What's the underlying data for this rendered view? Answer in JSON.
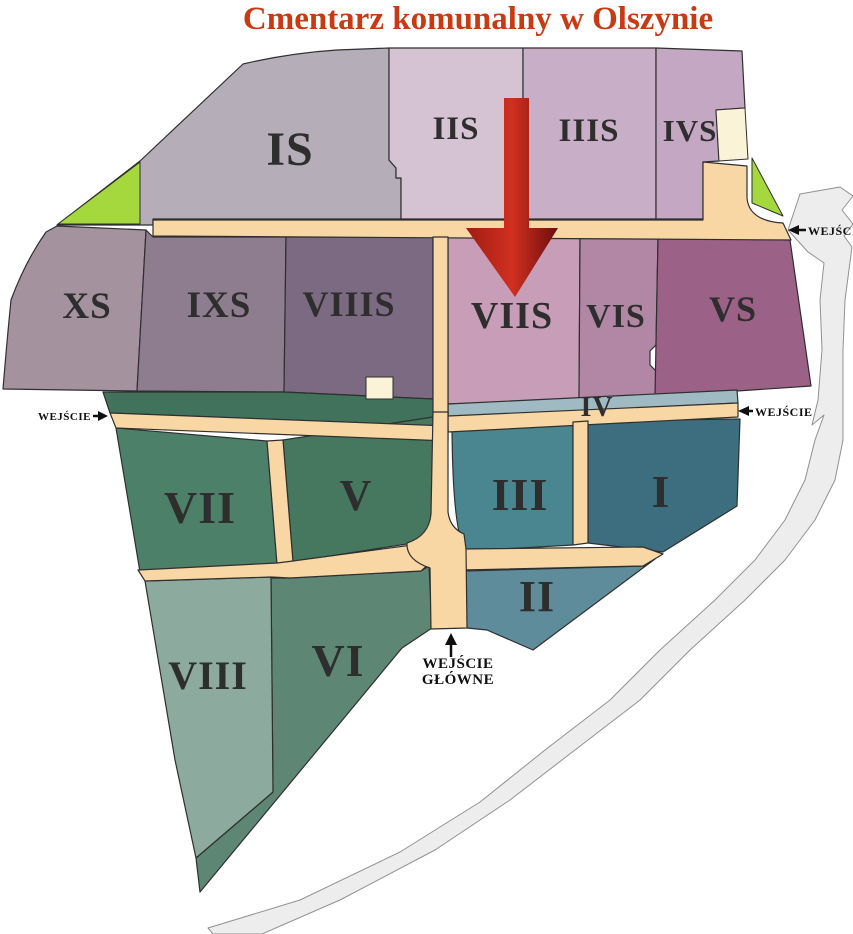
{
  "title": {
    "text": "Cmentarz komunalny w Olszynie",
    "color": "#c93a12"
  },
  "map": {
    "sections": [
      {
        "id": "IS",
        "label": "IS",
        "color": "#b5adb7"
      },
      {
        "id": "IIS",
        "label": "IIS",
        "color": "#d5c3d3"
      },
      {
        "id": "IIIS",
        "label": "IIIS",
        "color": "#c9aec7"
      },
      {
        "id": "IVS",
        "label": "IVS",
        "color": "#c4a7c2"
      },
      {
        "id": "XS",
        "label": "XS",
        "color": "#a5929f"
      },
      {
        "id": "IXS",
        "label": "IXS",
        "color": "#8e7d8e"
      },
      {
        "id": "VIIIS",
        "label": "VIIIS",
        "color": "#7b6a81"
      },
      {
        "id": "VIIS",
        "label": "VIIS",
        "color": "#c79db7"
      },
      {
        "id": "VIS",
        "label": "VIS",
        "color": "#b286a5"
      },
      {
        "id": "VS",
        "label": "VS",
        "color": "#9b6186"
      },
      {
        "id": "IV",
        "label": "IV",
        "color": "#9fbac3"
      },
      {
        "id": "VII",
        "label": "VII",
        "color": "#4d8068"
      },
      {
        "id": "V",
        "label": "V",
        "color": "#45785f"
      },
      {
        "id": "III",
        "label": "III",
        "color": "#4a8690"
      },
      {
        "id": "I",
        "label": "I",
        "color": "#3d6e7f"
      },
      {
        "id": "II",
        "label": "II",
        "color": "#5e8c9a"
      },
      {
        "id": "VI",
        "label": "VI",
        "color": "#5e8674"
      },
      {
        "id": "VIII",
        "label": "VIII",
        "color": "#8caa9e"
      }
    ],
    "entrances": [
      {
        "id": "east-upper",
        "label": "WEJŚCIE"
      },
      {
        "id": "west",
        "label": "WEJŚCIE"
      },
      {
        "id": "east-lower",
        "label": "WEJŚCIE"
      },
      {
        "id": "main",
        "label_line1": "WEJŚCIE",
        "label_line2": "GŁÓWNE"
      }
    ],
    "pointer_icon": "red-down-arrow",
    "colors": {
      "road": "#f8d7a5",
      "outer_path": "#ededed",
      "greenery": "#a5d83d",
      "building": "#faf3d7",
      "hedge": "#40725c",
      "arrow_start": "#a01c14",
      "arrow_mid": "#d03020",
      "arrow_end": "#6d0d0d"
    }
  }
}
